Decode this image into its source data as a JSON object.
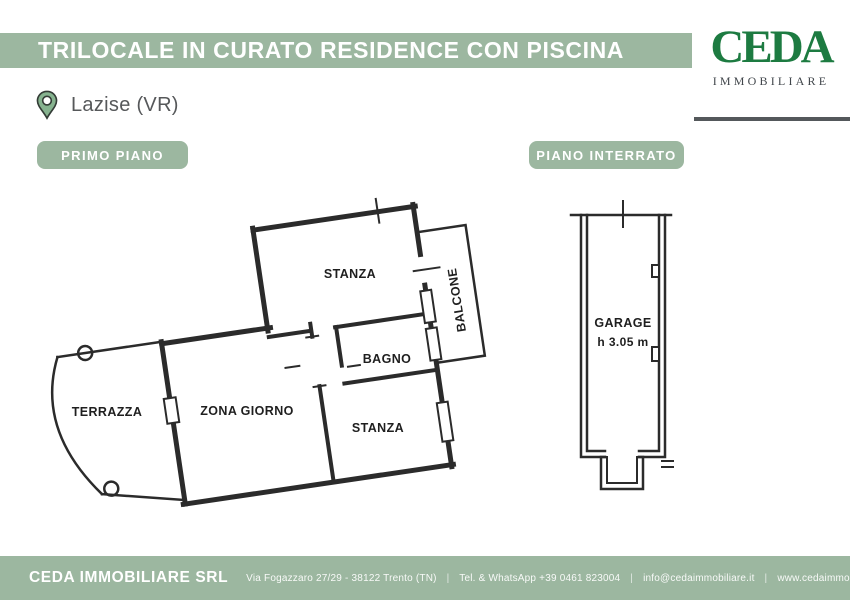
{
  "header": {
    "title": "TRILOCALE IN CURATO RESIDENCE CON PISCINA"
  },
  "logo": {
    "name": "CEDA",
    "subtitle": "IMMOBILIARE"
  },
  "location": {
    "label": "Lazise (VR)"
  },
  "badges": {
    "left": "PRIMO PIANO",
    "right": "PIANO INTERRATO"
  },
  "floorplan_primo_piano": {
    "rooms": {
      "stanza_top": "STANZA",
      "balcone": "BALCONE",
      "bagno": "BAGNO",
      "zona_giorno": "ZONA GIORNO",
      "stanza_bottom": "STANZA",
      "terrazza": "TERRAZZA"
    }
  },
  "floorplan_interrato": {
    "room": "GARAGE",
    "height_note": "h 3.05 m"
  },
  "footer": {
    "company": "CEDA IMMOBILIARE SRL",
    "separator": "|",
    "segments": [
      "Via Fogazzaro 27/29 - 38122 Trento (TN)",
      "Tel. & WhatsApp +39 0461 823004",
      "info@cedaimmobiliare.it",
      "www.cedaimmobiliare.it"
    ]
  },
  "colors": {
    "accent_green": "#9cb7a0",
    "logo_green": "#1d7b41",
    "plan_line": "#2b2b2b",
    "divider_gray": "#54585b"
  }
}
